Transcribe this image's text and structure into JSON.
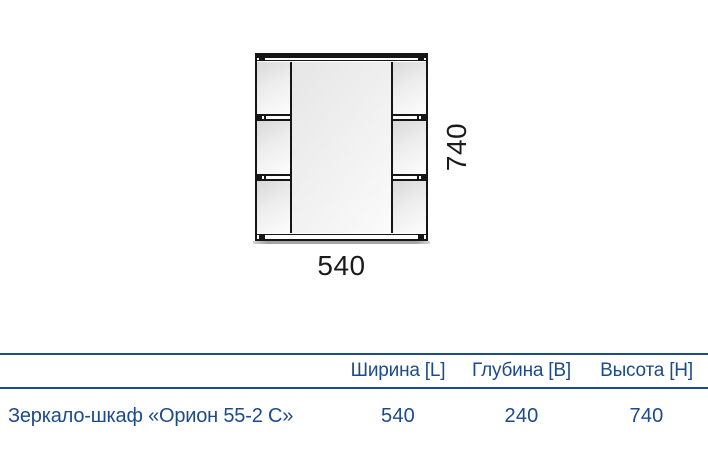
{
  "drawing": {
    "description": "front view of mirror cabinet with central mirror and side shelves",
    "width_label": "540",
    "height_label": "740"
  },
  "spec_table": {
    "columns": [
      "Ширина [L]",
      "Глубина [B]",
      "Высота [H]"
    ],
    "row": {
      "name": "Зеркало-шкаф «Орион 55-2 С»",
      "values": [
        "540",
        "240",
        "740"
      ]
    }
  },
  "colors": {
    "accent_blue": "#1c4a8c",
    "drawing_line": "#161616"
  }
}
